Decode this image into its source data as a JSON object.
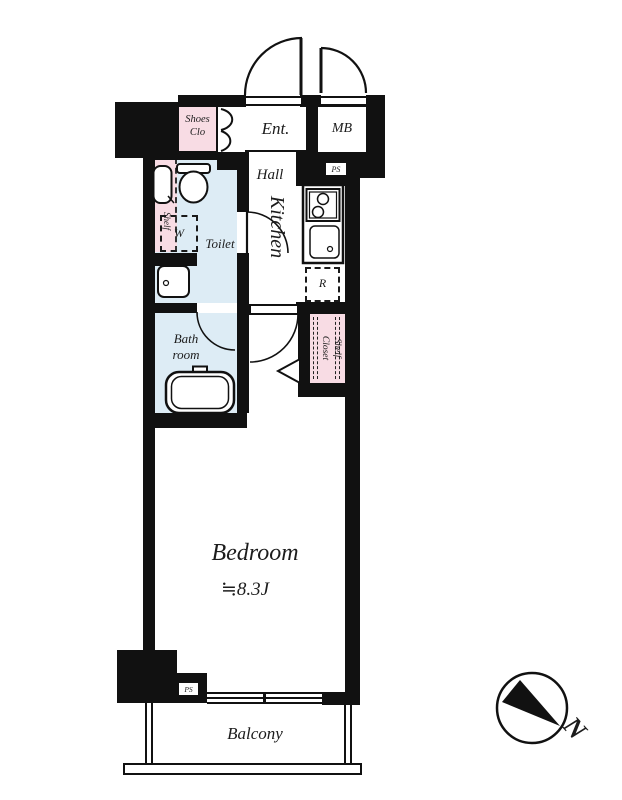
{
  "plan": {
    "labels": {
      "shoes_closet": "Shoes Clo",
      "entrance": "Ent.",
      "meter_box": "MB",
      "hall": "Hall",
      "pipe_space_top": "PS",
      "kitchen": "Kitchen",
      "toilet": "Toilet",
      "washer": "W",
      "shelf": "Shelf",
      "bathroom": "Bath room",
      "refrigerator": "R",
      "shelf_closet": "Shelf Closet",
      "bedroom": "Bedroom",
      "bedroom_size": "≒8.3J",
      "pipe_space_bottom": "PS",
      "balcony": "Balcony",
      "compass_north": "N"
    },
    "colors": {
      "wall": "#111111",
      "closet_pink": "#f8dce4",
      "wet_blue": "#ddecf5",
      "text": "#1c1c1c"
    }
  }
}
